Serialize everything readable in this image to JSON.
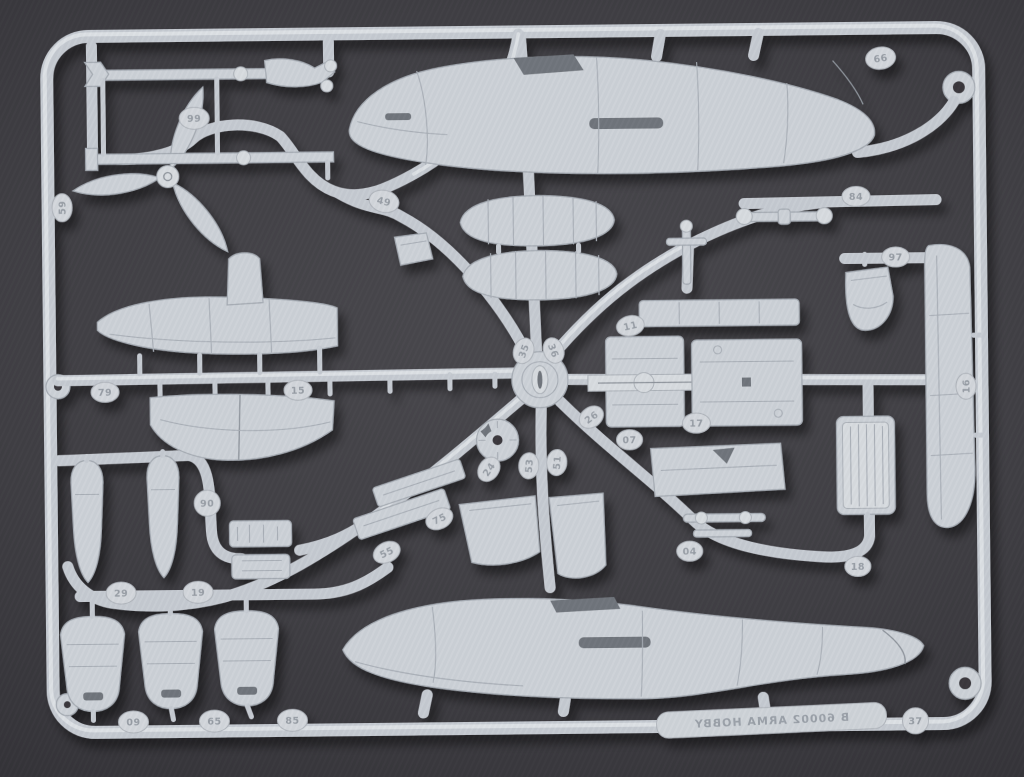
{
  "photo": {
    "subject": "model-kit-sprue",
    "colors": {
      "background": "#3f3e43",
      "plastic": "#cdd2d8",
      "plastic_shadow": "#a5abb3",
      "plastic_highlight": "#e2e6ea",
      "embossed_text": "#979da5"
    },
    "brand_plate": {
      "text": "B 60002 ARMA HOBBY",
      "mirrored": true
    },
    "part_tags": [
      "99",
      "59",
      "49",
      "66",
      "84",
      "97",
      "11",
      "35",
      "36",
      "79",
      "15",
      "16",
      "26",
      "17",
      "07",
      "24",
      "53",
      "51",
      "90",
      "75",
      "55",
      "04",
      "18",
      "29",
      "19",
      "09",
      "65",
      "85",
      "37"
    ]
  }
}
